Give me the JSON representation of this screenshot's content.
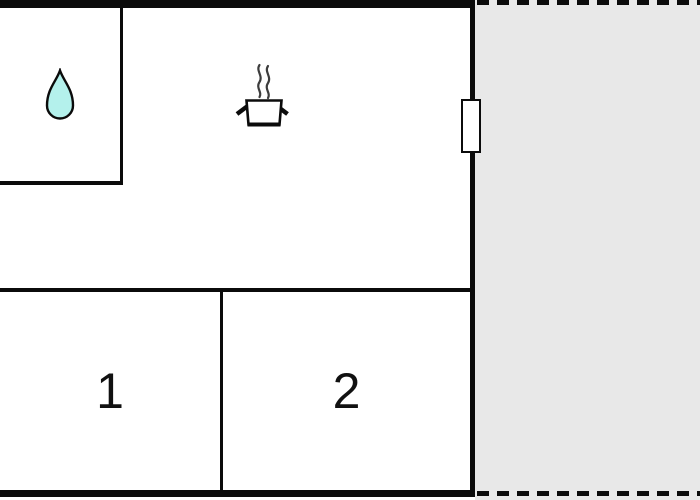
{
  "rooms": [
    {
      "label": "1"
    },
    {
      "label": "2"
    }
  ],
  "icons": {
    "bathroom": "water-drop-icon",
    "kitchen": "cooking-pot-icon"
  },
  "colors": {
    "wall": "#0b0b0b",
    "floor": "#ffffff",
    "terrace_fill": "#e8e8e8",
    "water_drop_fill": "#b4f1ec",
    "steam": "#3d3d3d"
  }
}
